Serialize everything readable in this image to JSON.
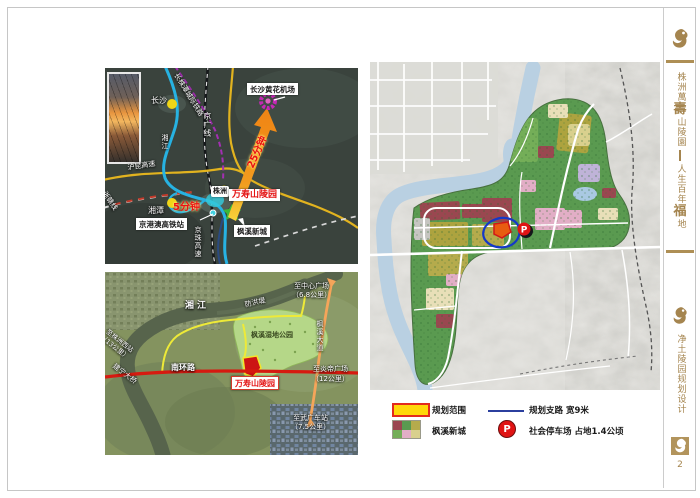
{
  "sidebar": {
    "brand": {
      "pre": "株洲萬",
      "big": "壽",
      "post": "山陵園"
    },
    "tagline": {
      "pre": "人生百年",
      "big": "福",
      "post": "地"
    },
    "section_title": "净土陵园规划设计",
    "page_number": "2"
  },
  "region_map": {
    "airport": "长沙黄花机场",
    "cemetery": "万寿山陵园",
    "hsr_station": "京港澳高铁站",
    "fengxi": "枫溪新城",
    "city_changsha": "长沙",
    "city_xiangtan": "湘潭",
    "city_zhuzhou": "株洲",
    "minutes_airport": "25分钟",
    "minutes_hsr": "5分钟",
    "river": "湘江",
    "rail_intercity": "长株潭城际铁路",
    "rail_jingguang": "京广线",
    "expwy_hukun": "沪昆高速",
    "rail_zhegan": "浙赣线",
    "expwy_jingzhu": "京珠高速"
  },
  "sat_map": {
    "river": "湘江",
    "dike": "防洪堤",
    "park": "枫溪湿地公园",
    "ring_road": "南环路",
    "site": "万寿山陵园",
    "avenue": "枫溪大道",
    "bridge": "建宁大桥",
    "west_l1": "至株洲西站",
    "west_l2": "（13公里）",
    "center_l1": "至中心广场",
    "center_l2": "（6.8公里）",
    "yandi_l1": "至炎帝广场",
    "yandi_l2": "（12公里）",
    "wuguang_l1": "至武广车站",
    "wuguang_l2": "（7.5公里）"
  },
  "plan_map": {
    "parking_marker": "P"
  },
  "legend": {
    "scope": "规划范围",
    "fengxi": "枫溪新城",
    "branch_road": "规划支路  宽9米",
    "parking": "社会停车场 占地1.4公顷",
    "parking_letter": "P"
  },
  "colors": {
    "accent_gold": "#a5854f",
    "scope_fill": "#ffd70a",
    "scope_border": "#e32a1e",
    "branch_road_blue": "#2b3f9e",
    "parking_red": "#e01414"
  }
}
